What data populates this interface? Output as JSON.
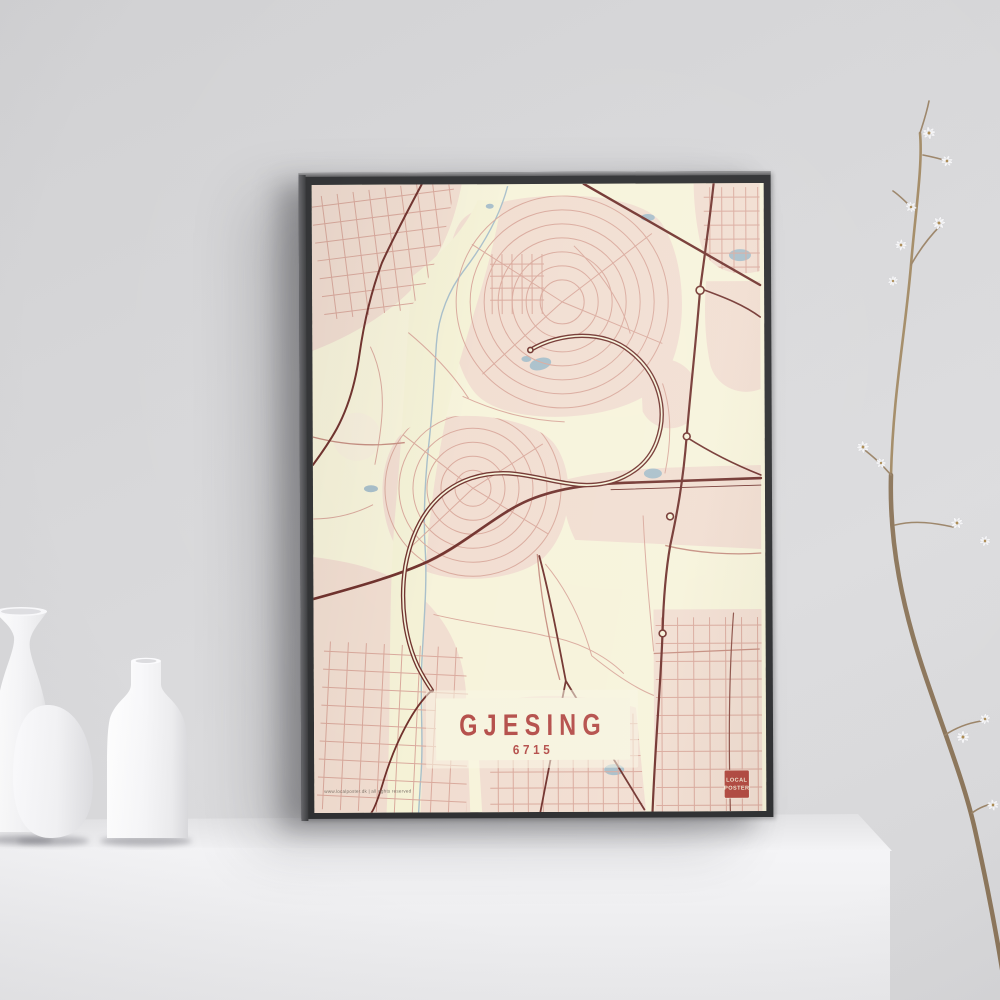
{
  "poster": {
    "title": "GJESING",
    "postal_code": "6715",
    "credit": "www.localposter.dk | all rights reserved",
    "badge": {
      "line1": "LOCAL",
      "line2": "POSTER"
    }
  },
  "colors": {
    "wall": "#d7d7d9",
    "pedestal": "#f3f3f5",
    "frame": "#2e2f31",
    "map_cream": "#f7f3da",
    "map_built": "#f1ddd0",
    "road_minor": "#d9a89b",
    "road_major": "#6e2e29",
    "water": "#a7bec9",
    "title_red": "#b34b47",
    "badge_red": "#b2483f",
    "badge_text": "#f3e9d4"
  }
}
